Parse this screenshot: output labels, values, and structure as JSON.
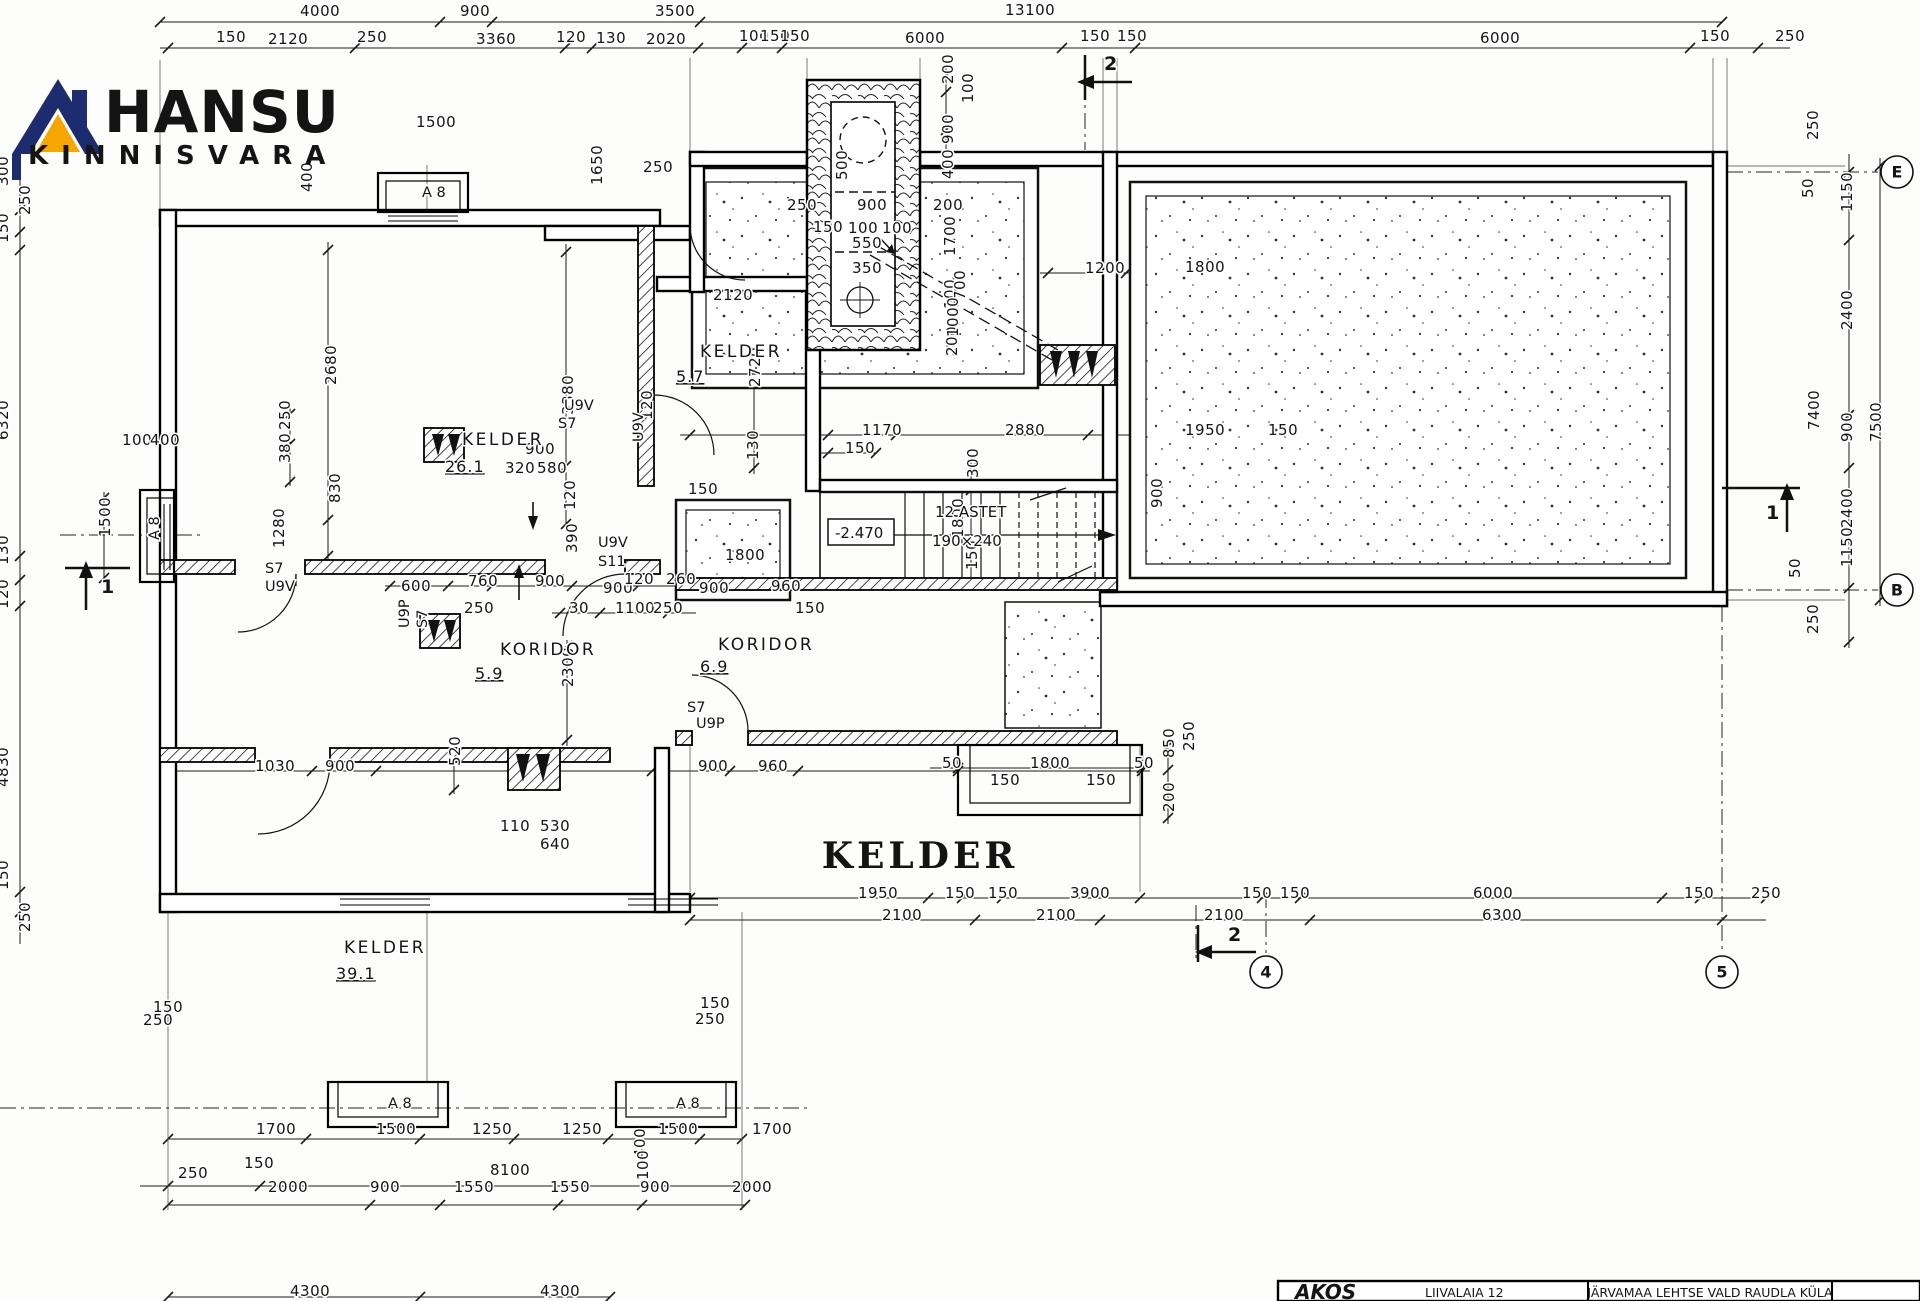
{
  "logo": {
    "title": "HANSU",
    "subtitle": "KINNISVARA",
    "navy": "#1d2b6f",
    "orange": "#f7a600"
  },
  "big_title": {
    "text": "KELDER",
    "color": "#e8491f",
    "x": 920,
    "y": 868
  },
  "title_block": {
    "brand": "AKOS",
    "address": "LIIVALAIA 12",
    "location": "JÄRVAMAA  LEHTSE VALD  RAUDLA KÜLA"
  },
  "stair": {
    "label": "12 ASTET",
    "size": "190×240",
    "level": "-2.470"
  },
  "rooms": [
    {
      "name": "KELDER",
      "area": "26.1",
      "nx": 462,
      "ny": 445,
      "ax": 445,
      "ay": 472
    },
    {
      "name": "KELDER",
      "area": "5.7",
      "nx": 700,
      "ny": 357,
      "ax": 676,
      "ay": 382
    },
    {
      "name": "KORIDOR",
      "area": "5.9",
      "nx": 500,
      "ny": 655,
      "ax": 475,
      "ay": 679
    },
    {
      "name": "KORIDOR",
      "area": "6.9",
      "nx": 718,
      "ny": 650,
      "ax": 700,
      "ay": 672
    },
    {
      "name": "KELDER",
      "area": "39.1",
      "nx": 344,
      "ny": 953,
      "ax": 336,
      "ay": 979
    }
  ],
  "grid_bubbles": [
    {
      "t": "E",
      "x": 1897,
      "y": 172
    },
    {
      "t": "B",
      "x": 1897,
      "y": 590
    },
    {
      "t": "4",
      "x": 1266,
      "y": 972
    },
    {
      "t": "5",
      "x": 1722,
      "y": 972
    }
  ],
  "section_markers": [
    {
      "t": "2",
      "x": 1104,
      "y": 70
    },
    {
      "t": "2",
      "x": 1228,
      "y": 941
    },
    {
      "t": "1",
      "x": 101,
      "y": 593
    },
    {
      "t": "1",
      "x": 1766,
      "y": 519
    }
  ],
  "door_labels": [
    [
      "S7",
      265,
      573,
      0
    ],
    [
      "U9V",
      265,
      591,
      0
    ],
    [
      "U9P",
      409,
      628,
      1
    ],
    [
      "S7",
      427,
      628,
      1
    ],
    [
      "U9V",
      564,
      410,
      0
    ],
    [
      "S7",
      558,
      428,
      0
    ],
    [
      "U9V",
      643,
      442,
      1
    ],
    [
      "U9V",
      598,
      547,
      0
    ],
    [
      "S11",
      598,
      566,
      0
    ],
    [
      "S7",
      687,
      712,
      0
    ],
    [
      "U9P",
      696,
      728,
      0
    ],
    [
      "A 8",
      422,
      197,
      0
    ],
    [
      "A 8",
      159,
      540,
      1
    ],
    [
      "A 8",
      388,
      1108,
      0
    ],
    [
      "A 8",
      676,
      1108,
      0
    ]
  ],
  "dims": [
    [
      "4000",
      300,
      16,
      0
    ],
    [
      "900",
      460,
      16,
      0
    ],
    [
      "3500",
      655,
      16,
      0
    ],
    [
      "13100",
      1005,
      15,
      0
    ],
    [
      "150",
      216,
      42,
      0
    ],
    [
      "2120",
      268,
      44,
      0
    ],
    [
      "250",
      357,
      42,
      0
    ],
    [
      "3360",
      476,
      44,
      0
    ],
    [
      "120",
      556,
      42,
      0
    ],
    [
      "130",
      596,
      43,
      0
    ],
    [
      "2020",
      646,
      44,
      0
    ],
    [
      "100",
      739,
      41,
      0
    ],
    [
      "150",
      760,
      41,
      0
    ],
    [
      "150",
      780,
      41,
      0
    ],
    [
      "6000",
      905,
      43,
      0
    ],
    [
      "150",
      1080,
      41,
      0
    ],
    [
      "150",
      1117,
      41,
      0
    ],
    [
      "6000",
      1480,
      43,
      0
    ],
    [
      "150",
      1700,
      41,
      0
    ],
    [
      "250",
      1775,
      41,
      0
    ],
    [
      "250",
      1818,
      140,
      1
    ],
    [
      "50",
      1813,
      198,
      1
    ],
    [
      "1150",
      1852,
      212,
      1
    ],
    [
      "2400",
      1852,
      330,
      1
    ],
    [
      "7400",
      1819,
      430,
      1
    ],
    [
      "900",
      1852,
      442,
      1
    ],
    [
      "7500",
      1881,
      442,
      1
    ],
    [
      "2400",
      1852,
      528,
      1
    ],
    [
      "1150",
      1852,
      567,
      1
    ],
    [
      "50",
      1800,
      578,
      1
    ],
    [
      "250",
      1818,
      634,
      1
    ],
    [
      "300",
      8,
      186,
      1
    ],
    [
      "250",
      30,
      215,
      1
    ],
    [
      "150",
      8,
      243,
      1
    ],
    [
      "6320",
      8,
      440,
      1
    ],
    [
      "1500",
      110,
      537,
      1
    ],
    [
      "130",
      8,
      565,
      1
    ],
    [
      "120",
      8,
      609,
      1
    ],
    [
      "4830",
      8,
      787,
      1
    ],
    [
      "150",
      8,
      890,
      1
    ],
    [
      "250",
      30,
      932,
      1
    ],
    [
      "100",
      122,
      445,
      0
    ],
    [
      "400",
      150,
      445,
      0
    ],
    [
      "150",
      153,
      1012,
      0
    ],
    [
      "250",
      143,
      1025,
      0
    ],
    [
      "150",
      700,
      1008,
      0
    ],
    [
      "250",
      695,
      1024,
      0
    ],
    [
      "1500",
      416,
      127,
      0
    ],
    [
      "400",
      312,
      192,
      1
    ],
    [
      "1650",
      602,
      185,
      1
    ],
    [
      "250",
      643,
      172,
      0
    ],
    [
      "500",
      847,
      180,
      1
    ],
    [
      "250",
      787,
      210,
      0
    ],
    [
      "900",
      857,
      210,
      0
    ],
    [
      "200",
      933,
      210,
      0
    ],
    [
      "150",
      813,
      232,
      0
    ],
    [
      "100",
      848,
      233,
      0
    ],
    [
      "100",
      882,
      233,
      0
    ],
    [
      "550",
      852,
      248,
      0
    ],
    [
      "350",
      852,
      273,
      0
    ],
    [
      "200",
      953,
      84,
      1
    ],
    [
      "100",
      973,
      103,
      1
    ],
    [
      "900",
      953,
      144,
      1
    ],
    [
      "400",
      953,
      179,
      1
    ],
    [
      "1700",
      955,
      256,
      1
    ],
    [
      "100",
      955,
      309,
      1
    ],
    [
      "200",
      957,
      356,
      1
    ],
    [
      "1200",
      1085,
      273,
      0
    ],
    [
      "1800",
      1185,
      272,
      0
    ],
    [
      "700",
      965,
      300,
      1
    ],
    [
      "1000",
      958,
      337,
      1
    ],
    [
      "1170",
      862,
      435,
      0
    ],
    [
      "2880",
      1005,
      435,
      0
    ],
    [
      "1950",
      1185,
      435,
      0
    ],
    [
      "150",
      1268,
      435,
      0
    ],
    [
      "150",
      845,
      453,
      0
    ],
    [
      "2680",
      336,
      385,
      1
    ],
    [
      "830",
      340,
      503,
      1
    ],
    [
      "900",
      525,
      454,
      0
    ],
    [
      "320",
      505,
      473,
      0
    ],
    [
      "580",
      537,
      473,
      0
    ],
    [
      "250",
      290,
      430,
      1
    ],
    [
      "380",
      290,
      463,
      1
    ],
    [
      "1280",
      284,
      548,
      1
    ],
    [
      "2120",
      713,
      300,
      0
    ],
    [
      "2720",
      760,
      387,
      1
    ],
    [
      "130",
      758,
      460,
      1
    ],
    [
      "3380",
      573,
      415,
      1
    ],
    [
      "120",
      575,
      510,
      1
    ],
    [
      "120",
      652,
      420,
      1
    ],
    [
      "390",
      577,
      553,
      1
    ],
    [
      "600",
      401,
      591,
      0
    ],
    [
      "760",
      468,
      586,
      0
    ],
    [
      "900",
      535,
      586,
      0
    ],
    [
      "250",
      464,
      613,
      0
    ],
    [
      "30",
      569,
      613,
      0
    ],
    [
      "1100",
      615,
      613,
      0
    ],
    [
      "250",
      653,
      613,
      0
    ],
    [
      "900",
      603,
      593,
      0
    ],
    [
      "120",
      624,
      584,
      0
    ],
    [
      "260",
      666,
      584,
      0
    ],
    [
      "900",
      699,
      593,
      0
    ],
    [
      "960",
      771,
      591,
      0
    ],
    [
      "150",
      795,
      613,
      0
    ],
    [
      "2300",
      573,
      687,
      1
    ],
    [
      "150",
      688,
      494,
      0
    ],
    [
      "1800",
      725,
      560,
      0
    ],
    [
      "300",
      978,
      478,
      1
    ],
    [
      "1800",
      963,
      538,
      1
    ],
    [
      "150",
      977,
      570,
      1
    ],
    [
      "900",
      1162,
      508,
      1
    ],
    [
      "900",
      698,
      771,
      0
    ],
    [
      "960",
      758,
      771,
      0
    ],
    [
      "50",
      942,
      768,
      0
    ],
    [
      "1800",
      1030,
      768,
      0
    ],
    [
      "50",
      1134,
      768,
      0
    ],
    [
      "150",
      990,
      785,
      0
    ],
    [
      "150",
      1086,
      785,
      0
    ],
    [
      "850",
      1174,
      758,
      1
    ],
    [
      "250",
      1194,
      751,
      1
    ],
    [
      "200",
      1174,
      812,
      1
    ],
    [
      "1030",
      255,
      771,
      0
    ],
    [
      "900",
      325,
      771,
      0
    ],
    [
      "520",
      460,
      766,
      1
    ],
    [
      "110",
      500,
      831,
      0
    ],
    [
      "530",
      540,
      831,
      0
    ],
    [
      "640",
      540,
      849,
      0
    ],
    [
      "1950",
      858,
      898,
      0
    ],
    [
      "150",
      945,
      898,
      0
    ],
    [
      "150",
      988,
      898,
      0
    ],
    [
      "3900",
      1070,
      898,
      0
    ],
    [
      "150",
      1242,
      898,
      0
    ],
    [
      "150",
      1280,
      898,
      0
    ],
    [
      "6000",
      1473,
      898,
      0
    ],
    [
      "150",
      1684,
      898,
      0
    ],
    [
      "250",
      1751,
      898,
      0
    ],
    [
      "2100",
      882,
      920,
      0
    ],
    [
      "2100",
      1036,
      920,
      0
    ],
    [
      "2100",
      1204,
      920,
      0
    ],
    [
      "6300",
      1482,
      920,
      0
    ],
    [
      "1700",
      256,
      1134,
      0
    ],
    [
      "1500",
      376,
      1134,
      0
    ],
    [
      "1250",
      472,
      1134,
      0
    ],
    [
      "1250",
      562,
      1134,
      0
    ],
    [
      "1500",
      658,
      1134,
      0
    ],
    [
      "1700",
      752,
      1134,
      0
    ],
    [
      "150",
      244,
      1168,
      0
    ],
    [
      "250",
      178,
      1178,
      0
    ],
    [
      "8100",
      490,
      1175,
      0
    ],
    [
      "2000",
      268,
      1192,
      0
    ],
    [
      "900",
      370,
      1192,
      0
    ],
    [
      "1550",
      454,
      1192,
      0
    ],
    [
      "1550",
      550,
      1192,
      0
    ],
    [
      "900",
      640,
      1192,
      0
    ],
    [
      "2000",
      732,
      1192,
      0
    ],
    [
      "400",
      645,
      1158,
      1
    ],
    [
      "100",
      648,
      1180,
      1
    ],
    [
      "4300",
      290,
      1296,
      0
    ],
    [
      "4300",
      540,
      1296,
      0
    ]
  ],
  "chains": [
    {
      "o": "h",
      "p": 22,
      "a": 160,
      "b": 1722,
      "t": [
        160,
        440,
        492,
        700,
        1722
      ]
    },
    {
      "o": "h",
      "p": 48,
      "a": 160,
      "b": 1790,
      "t": [
        168,
        355,
        565,
        592,
        698,
        742,
        782,
        1062,
        1135,
        1690,
        1758
      ]
    },
    {
      "o": "h",
      "p": 435,
      "a": 680,
      "b": 1300,
      "t": [
        690,
        828,
        896,
        1088,
        1300
      ]
    },
    {
      "o": "h",
      "p": 453,
      "a": 820,
      "b": 876,
      "t": [
        828,
        876
      ]
    },
    {
      "o": "h",
      "p": 586,
      "a": 385,
      "b": 810,
      "t": [
        390,
        448,
        492,
        572,
        638,
        680,
        736,
        800
      ]
    },
    {
      "o": "h",
      "p": 613,
      "a": 552,
      "b": 696,
      "t": [
        560,
        600,
        668
      ]
    },
    {
      "o": "h",
      "p": 771,
      "a": 168,
      "b": 1150,
      "t": [
        168,
        312,
        376,
        652,
        730,
        798,
        958,
        1142
      ]
    },
    {
      "o": "h",
      "p": 768,
      "a": 930,
      "b": 1150,
      "t": [
        958,
        1142
      ]
    },
    {
      "o": "h",
      "p": 898,
      "a": 690,
      "b": 1766,
      "t": [
        690,
        928,
        962,
        1002,
        1140,
        1262,
        1300,
        1662,
        1700,
        1766
      ]
    },
    {
      "o": "h",
      "p": 920,
      "a": 690,
      "b": 1766,
      "t": [
        690,
        975,
        1100,
        1310,
        1722
      ]
    },
    {
      "o": "h",
      "p": 1139,
      "a": 168,
      "b": 742,
      "t": [
        168,
        306,
        420,
        514,
        608,
        700,
        742
      ]
    },
    {
      "o": "h",
      "p": 1186,
      "a": 140,
      "b": 745,
      "t": [
        168,
        260,
        745
      ]
    },
    {
      "o": "h",
      "p": 1205,
      "a": 168,
      "b": 745,
      "t": [
        168,
        370,
        440,
        558,
        642,
        745
      ]
    },
    {
      "o": "h",
      "p": 1297,
      "a": 168,
      "b": 610,
      "t": [
        168,
        420,
        610
      ]
    },
    {
      "o": "h",
      "p": 210,
      "a": 770,
      "b": 948,
      "t": [
        778,
        798,
        912,
        944
      ]
    },
    {
      "o": "h",
      "p": 233,
      "a": 800,
      "b": 898,
      "t": [
        806,
        838,
        862,
        896
      ]
    },
    {
      "o": "h",
      "p": 273,
      "a": 1040,
      "b": 1240,
      "t": [
        1048,
        1126,
        1238
      ]
    },
    {
      "o": "v",
      "p": 20,
      "a": 172,
      "b": 944,
      "t": [
        210,
        232,
        250,
        556,
        580,
        606,
        892,
        912
      ]
    },
    {
      "o": "v",
      "p": 1849,
      "a": 154,
      "b": 648,
      "t": [
        172,
        240,
        415,
        468,
        588,
        642
      ]
    },
    {
      "o": "v",
      "p": 1880,
      "a": 158,
      "b": 606,
      "t": [
        166,
        600
      ]
    },
    {
      "o": "v",
      "p": 946,
      "a": 62,
      "b": 372,
      "t": [
        76,
        92,
        130,
        166,
        200,
        312,
        330,
        366
      ]
    },
    {
      "o": "v",
      "p": 566,
      "a": 244,
      "b": 530,
      "t": [
        252,
        466,
        524
      ]
    },
    {
      "o": "v",
      "p": 328,
      "a": 242,
      "b": 562,
      "t": [
        250,
        520,
        556
      ]
    },
    {
      "o": "v",
      "p": 290,
      "a": 408,
      "b": 486,
      "t": [
        414,
        444,
        482
      ]
    },
    {
      "o": "v",
      "p": 754,
      "a": 296,
      "b": 474,
      "t": [
        302,
        468
      ]
    },
    {
      "o": "v",
      "p": 1156,
      "a": 482,
      "b": 540,
      "t": [
        488,
        534
      ]
    },
    {
      "o": "v",
      "p": 567,
      "a": 640,
      "b": 746,
      "t": [
        646,
        740
      ]
    },
    {
      "o": "v",
      "p": 104,
      "a": 492,
      "b": 584,
      "t": [
        498,
        578
      ]
    },
    {
      "o": "v",
      "p": 1168,
      "a": 742,
      "b": 824,
      "t": [
        746,
        770,
        818
      ]
    },
    {
      "o": "v",
      "p": 454,
      "a": 748,
      "b": 794,
      "t": [
        752,
        790
      ]
    },
    {
      "o": "v",
      "p": 971,
      "a": 462,
      "b": 590,
      "t": [
        468,
        490,
        584
      ]
    }
  ]
}
